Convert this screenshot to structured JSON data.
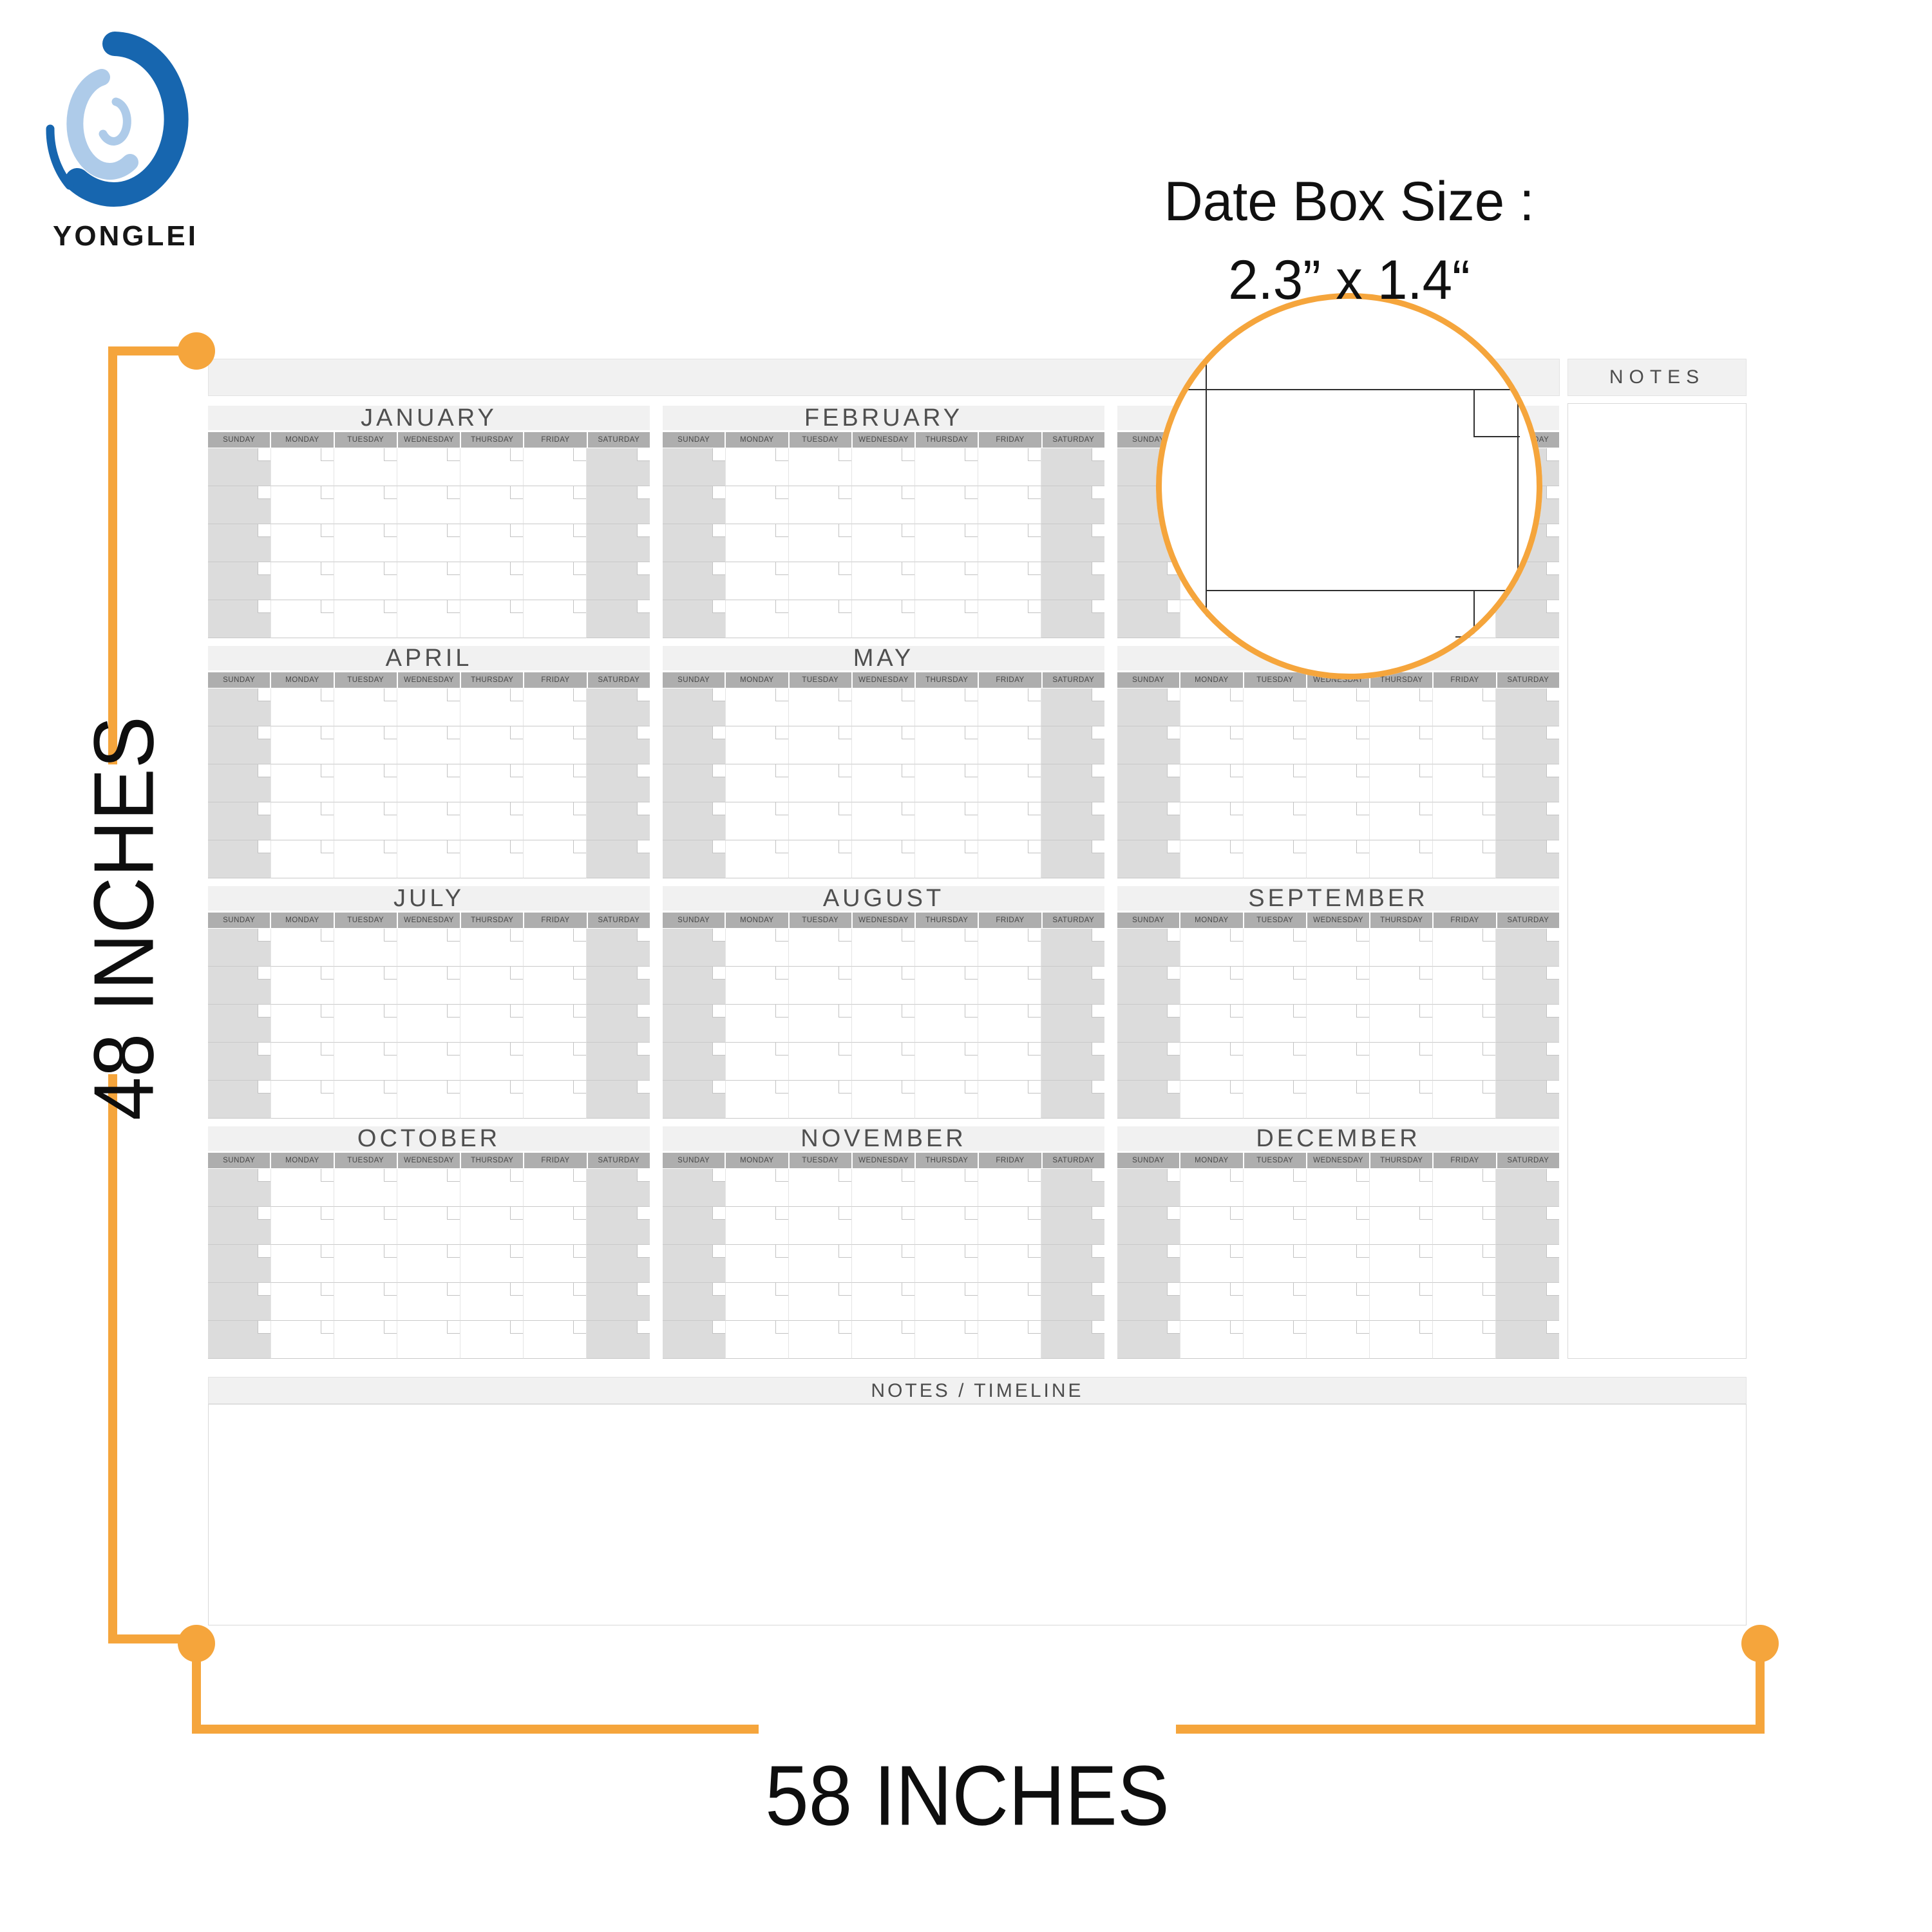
{
  "brand": {
    "name": "YONGLEI"
  },
  "callout": {
    "title": "Date Box Size :",
    "size": "2.3” x 1.4“"
  },
  "dimensions": {
    "height_label": "48 INCHES",
    "width_label": "58 INCHES"
  },
  "panels": {
    "notes_label": "NOTES",
    "notes_timeline_label": "NOTES / TIMELINE"
  },
  "calendar": {
    "months": [
      "JANUARY",
      "FEBRUARY",
      "MARCH",
      "APRIL",
      "MAY",
      "JUNE",
      "JULY",
      "AUGUST",
      "SEPTEMBER",
      "OCTOBER",
      "NOVEMBER",
      "DECEMBER"
    ],
    "weekdays": [
      "SUNDAY",
      "MONDAY",
      "TUESDAY",
      "WEDNESDAY",
      "THURSDAY",
      "FRIDAY",
      "SATURDAY"
    ],
    "weeks_per_month": 5
  },
  "colors": {
    "accent_orange": "#F5A53C",
    "logo_blue": "#1766AF",
    "logo_light_blue": "#AECBE9",
    "band_gray": "#F1F1F1",
    "weekday_band_gray": "#AEAEAE",
    "weekend_column_gray": "#DCDCDC"
  }
}
